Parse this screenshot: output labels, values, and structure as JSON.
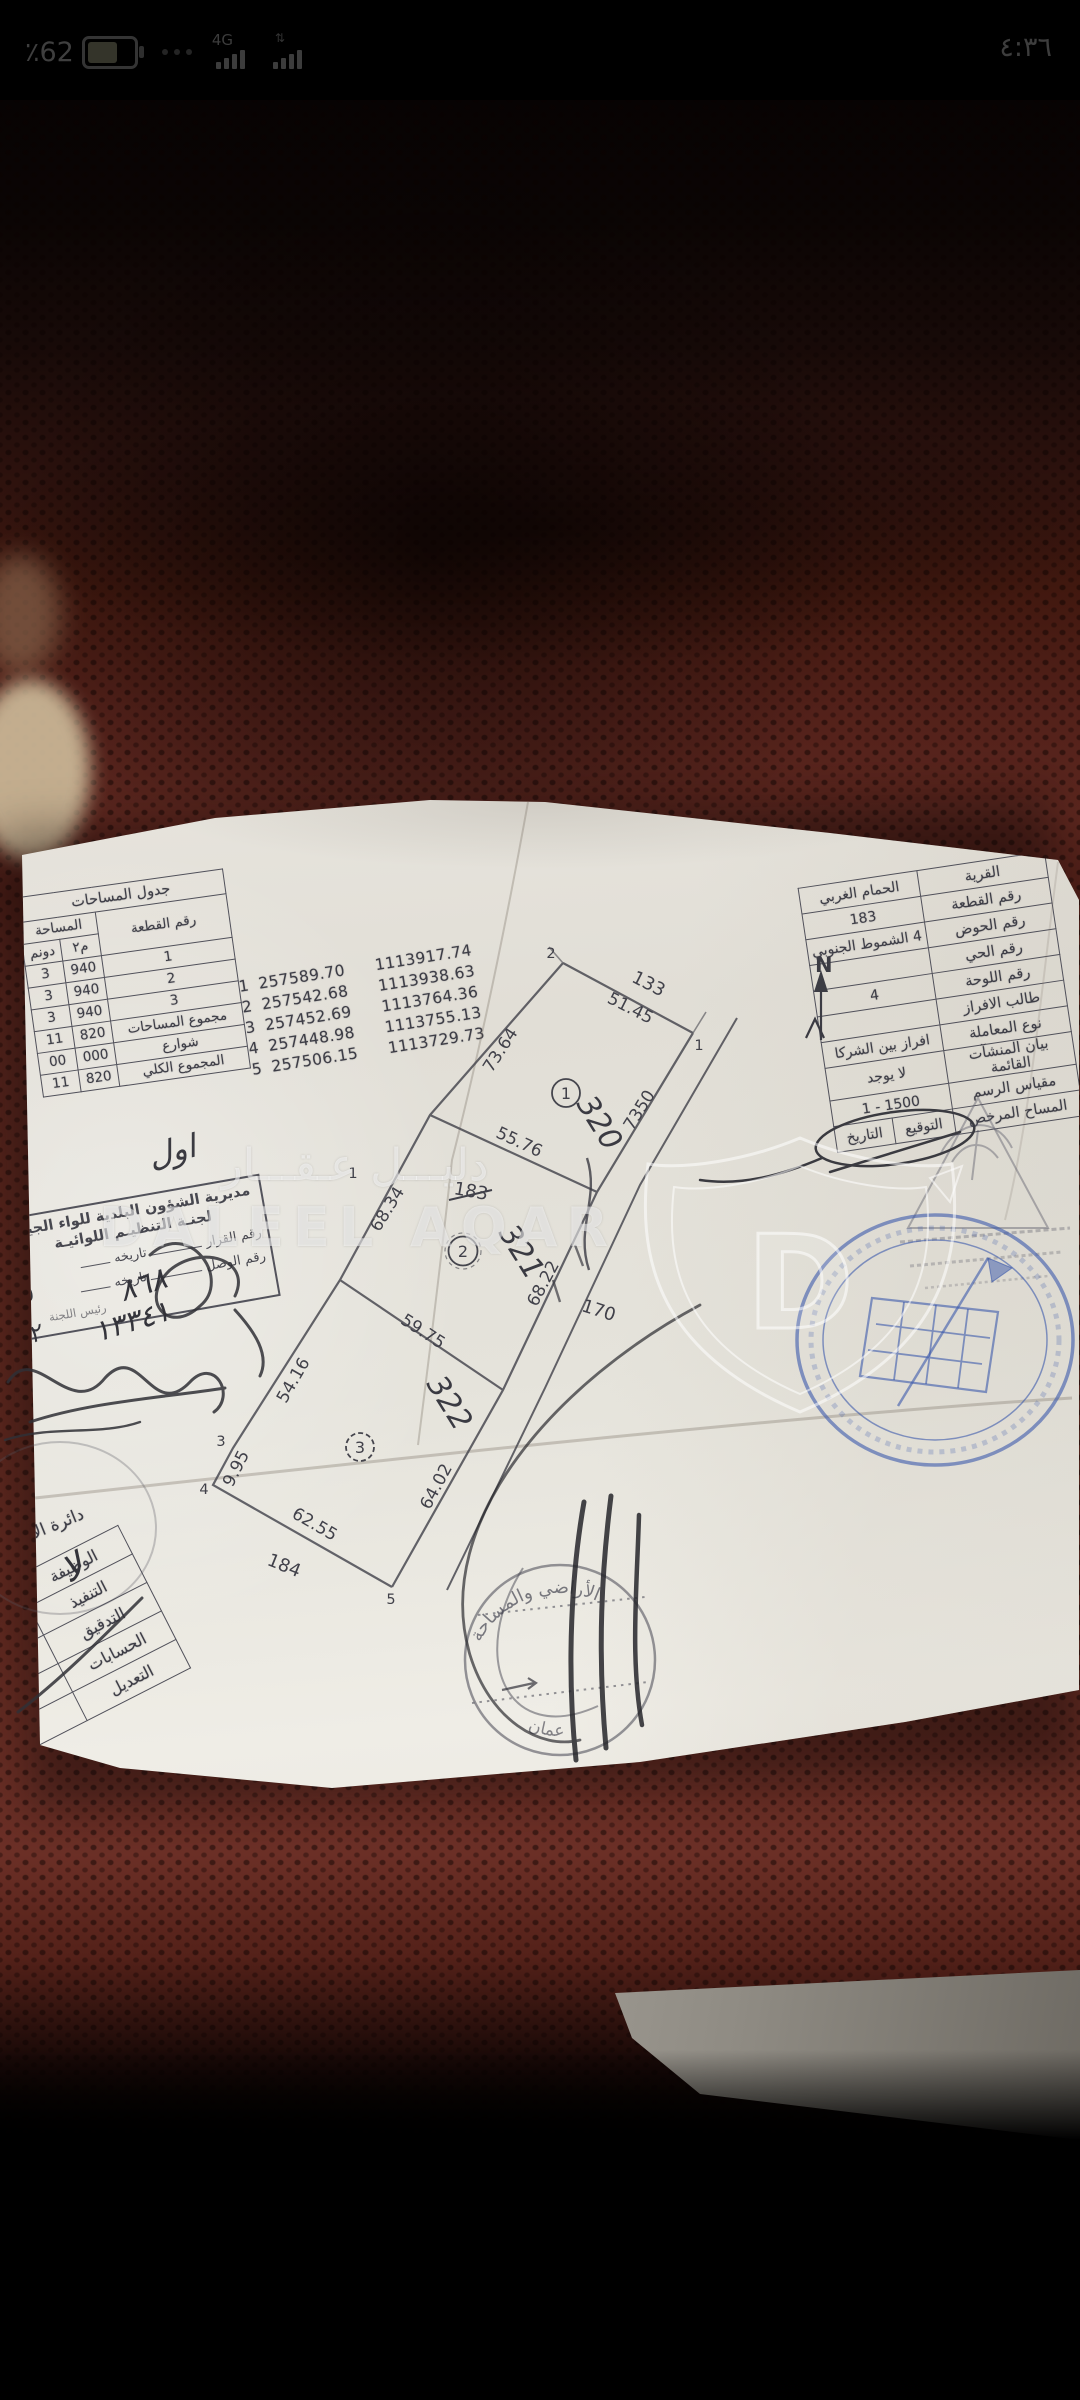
{
  "status_bar": {
    "battery": "٪62",
    "network": "4G",
    "time": "٤:٣٦"
  },
  "watermark": {
    "arabic": "دليـــل عـقـــار",
    "latin": "DALEEL AQAR"
  },
  "areas_table": {
    "title": "جدول المساحات",
    "col_parcel": "رقم القطعة",
    "col_area": "المساحة",
    "col_m2": "م٢",
    "col_dunum": "دونم",
    "rows": [
      [
        "1",
        "940",
        "3"
      ],
      [
        "2",
        "940",
        "3"
      ],
      [
        "3",
        "940",
        "3"
      ],
      [
        "مجموع المساحات",
        "820",
        "11"
      ],
      [
        "شوارع",
        "000",
        "00"
      ],
      [
        "المجموع الكلي",
        "820",
        "11"
      ]
    ]
  },
  "coordinates": [
    [
      "1",
      "257589.70",
      "1113917.74"
    ],
    [
      "2",
      "257542.68",
      "1113938.63"
    ],
    [
      "3",
      "257452.69",
      "1113764.36"
    ],
    [
      "4",
      "257448.98",
      "1113755.13"
    ],
    [
      "5",
      "257506.15",
      "1113729.73"
    ]
  ],
  "info_table": {
    "rows": [
      {
        "label": "القرية",
        "value": "الحمام الغربي"
      },
      {
        "label": "رقم القطعة",
        "value": "183"
      },
      {
        "label": "رقم الحوض",
        "value": "4 الشموط الجنوبي"
      },
      {
        "label": "رقم الحي",
        "value": ""
      },
      {
        "label": "رقم اللوحة",
        "value": "4"
      },
      {
        "label": "طالب الافراز",
        "value": ""
      },
      {
        "label": "نوع المعاملة",
        "value": "افراز بين الشركا"
      },
      {
        "label": "بيان المنشآت القائمة",
        "value": "لا يوجد"
      },
      {
        "label": "مقياس الرسم",
        "value": "1500 - 1"
      },
      {
        "label": "المساح المرخص",
        "sign": "التوقيع",
        "date": "التاريخ"
      }
    ]
  },
  "plan": {
    "north": "N",
    "dims": {
      "top": "51.45",
      "left_upper": "73.64",
      "div_1_2": "55.76",
      "left_mid": "68.34",
      "road_mid": "68.22",
      "div_2_3": "59.75",
      "left_lower": "54.16",
      "left_bottom": "9.95",
      "bottom": "62.55",
      "road_lower": "64.02"
    },
    "adjacent_parcels": {
      "top": "133",
      "east": "170",
      "south": "184"
    },
    "point_labels": {
      "p1": "1",
      "p2": "2",
      "p3": "3",
      "p4": "4",
      "p5": "5",
      "stray": "1"
    },
    "parcel_circles": [
      "1",
      "2",
      "3"
    ],
    "handwritten": [
      "320",
      "321",
      "322"
    ],
    "crossed_parcel": "183",
    "road_number": "7350"
  },
  "committee_stamp": {
    "line1": "مديرية الشؤون البلدية للواء الجيزة",
    "line2": "لجنـة التنظيـم اللوائيـة",
    "decision_label": "رقم القرار",
    "date_label": "تاريخه",
    "receipt_label": "رقم الوصل",
    "decision_no": "٨٦٨",
    "decision_date": "١٥",
    "receipt_no": "١٣٣٤١",
    "receipt_date": "٢٢",
    "chief_label": "رئيس اللجنة",
    "handwritten_top": "اول"
  },
  "dept_table": {
    "header": "دائرة الأ",
    "rows": [
      "الوظيفة",
      "التنفيذ",
      "التدقيق",
      "الحسابات",
      "التعديل"
    ],
    "handwritten": "لا"
  },
  "round_stamp": {
    "top": "الأراضي والمساحة",
    "bottom": "عمان"
  }
}
